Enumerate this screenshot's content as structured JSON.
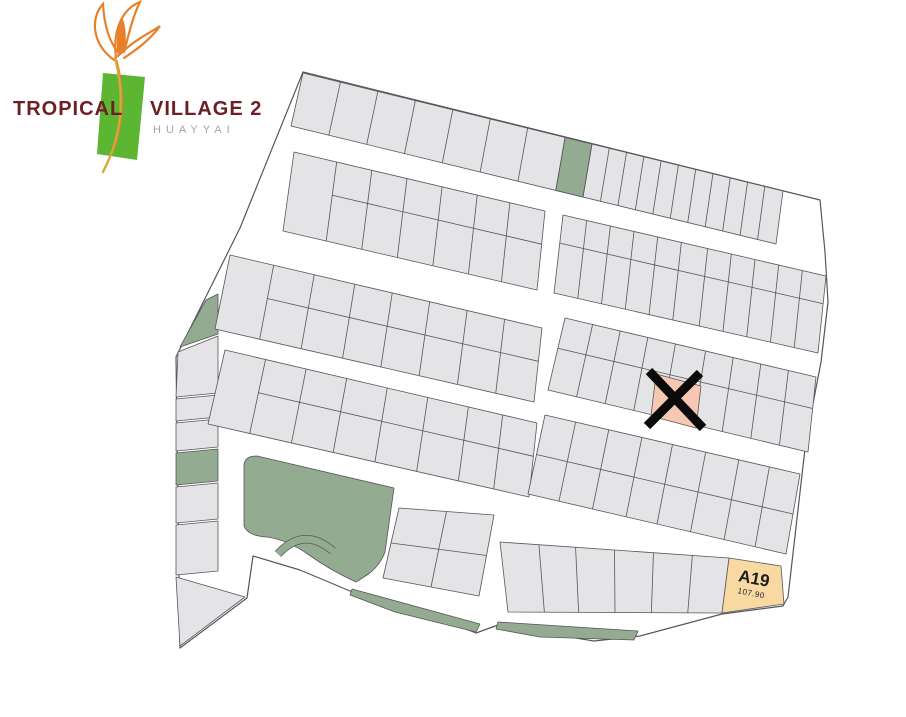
{
  "logo": {
    "title_left": "TROPICAL",
    "title_right": "VILLAGE 2",
    "subtitle": "HUAYYAI",
    "text_color": "#6e1e25",
    "subtitle_color": "#a5a3a3",
    "leaf_color": "#5cb632",
    "flower_color": "#e8802b",
    "stem_color": "#d9a83d"
  },
  "map": {
    "colors": {
      "background": "#ffffff",
      "plot": "#e4e4e6",
      "line": "#55565a",
      "green": "#93ab90",
      "salmon": "#f6c8b2",
      "yellow": "#f8d9a1",
      "mark": "#0b0b0b",
      "label_dark": "#1d1d1f"
    },
    "outline": [
      [
        303,
        72
      ],
      [
        820,
        200
      ],
      [
        825,
        252
      ],
      [
        828,
        302
      ],
      [
        821,
        362
      ],
      [
        806,
        440
      ],
      [
        788,
        597
      ],
      [
        783,
        606
      ],
      [
        722,
        614
      ],
      [
        640,
        636
      ],
      [
        594,
        641
      ],
      [
        540,
        632
      ],
      [
        498,
        625
      ],
      [
        476,
        633
      ],
      [
        430,
        615
      ],
      [
        398,
        610
      ],
      [
        350,
        591
      ],
      [
        300,
        570
      ],
      [
        253,
        556
      ],
      [
        247,
        598
      ],
      [
        180,
        648
      ],
      [
        176,
        357
      ],
      [
        240,
        228
      ]
    ],
    "blocks": [
      {
        "name": "row-1",
        "poly": [
          [
            303,
            73
          ],
          [
            783,
            191
          ],
          [
            776,
            244
          ],
          [
            291,
            126
          ]
        ],
        "cuts": [
          0.078,
          0.156,
          0.234,
          0.312,
          0.39,
          0.468,
          0.546,
          0.602,
          0.638,
          0.674,
          0.71,
          0.746,
          0.782,
          0.818,
          0.854,
          0.89,
          0.926,
          0.962
        ],
        "fills": [
          {
            "from": 0.546,
            "to": 0.602,
            "color": "green"
          }
        ]
      },
      {
        "name": "row-2-left",
        "poly": [
          [
            294,
            152
          ],
          [
            545,
            211
          ],
          [
            537,
            290
          ],
          [
            283,
            231
          ]
        ],
        "cuts": [
          0.17,
          0.31,
          0.45,
          0.59,
          0.73,
          0.86
        ],
        "mid": 0.42,
        "midStart": 0.17
      },
      {
        "name": "row-2-right",
        "poly": [
          [
            563,
            215
          ],
          [
            826,
            276
          ],
          [
            818,
            353
          ],
          [
            554,
            293
          ]
        ],
        "cuts": [
          0.09,
          0.18,
          0.27,
          0.36,
          0.45,
          0.55,
          0.64,
          0.73,
          0.82,
          0.91
        ],
        "mid": 0.36
      },
      {
        "name": "row-3-left",
        "poly": [
          [
            230,
            255
          ],
          [
            542,
            328
          ],
          [
            534,
            402
          ],
          [
            215,
            329
          ]
        ],
        "cuts": [
          0.14,
          0.27,
          0.4,
          0.52,
          0.64,
          0.76,
          0.88
        ],
        "mid": 0.45,
        "midStart": 0.14
      },
      {
        "name": "row-3-right",
        "poly": [
          [
            565,
            318
          ],
          [
            816,
            377
          ],
          [
            808,
            452
          ],
          [
            548,
            390
          ]
        ],
        "cuts": [
          0.11,
          0.22,
          0.33,
          0.44,
          0.56,
          0.67,
          0.78,
          0.89
        ],
        "mid": 0.42
      },
      {
        "name": "row-4-left",
        "poly": [
          [
            225,
            350
          ],
          [
            537,
            423
          ],
          [
            529,
            497
          ],
          [
            208,
            424
          ]
        ],
        "cuts": [
          0.13,
          0.26,
          0.39,
          0.52,
          0.65,
          0.78,
          0.89
        ],
        "mid": 0.45,
        "midStart": 0.13
      },
      {
        "name": "row-4-right",
        "poly": [
          [
            545,
            415
          ],
          [
            800,
            474
          ],
          [
            786,
            554
          ],
          [
            528,
            494
          ]
        ],
        "cuts": [
          0.12,
          0.25,
          0.38,
          0.5,
          0.63,
          0.76,
          0.88
        ],
        "mid": 0.5
      },
      {
        "name": "pond-side-block",
        "poly": [
          [
            399,
            508
          ],
          [
            494,
            515
          ],
          [
            479,
            596
          ],
          [
            383,
            578
          ]
        ],
        "cuts": [
          0.5
        ],
        "mid": 0.5
      },
      {
        "name": "bottom-row",
        "poly": [
          [
            500,
            542
          ],
          [
            729,
            558
          ],
          [
            722,
            613
          ],
          [
            508,
            612
          ]
        ],
        "cuts": [
          0.17,
          0.33,
          0.5,
          0.67,
          0.84
        ]
      }
    ],
    "strip_cells": [
      {
        "poly": [
          [
            206,
            300
          ],
          [
            218,
            294
          ],
          [
            218,
            334
          ],
          [
            180,
            347
          ]
        ],
        "color": "green"
      },
      {
        "poly": [
          [
            178,
            352
          ],
          [
            218,
            336
          ],
          [
            218,
            393
          ],
          [
            176,
            397
          ]
        ],
        "color": "plot"
      },
      {
        "poly": [
          [
            176,
            399
          ],
          [
            218,
            395
          ],
          [
            218,
            417
          ],
          [
            176,
            421
          ]
        ],
        "color": "plot"
      },
      {
        "poly": [
          [
            176,
            423
          ],
          [
            218,
            419
          ],
          [
            218,
            447
          ],
          [
            176,
            451
          ]
        ],
        "color": "plot"
      },
      {
        "poly": [
          [
            176,
            453
          ],
          [
            218,
            449
          ],
          [
            218,
            481
          ],
          [
            176,
            485
          ]
        ],
        "color": "green"
      },
      {
        "poly": [
          [
            176,
            487
          ],
          [
            218,
            483
          ],
          [
            218,
            519
          ],
          [
            176,
            523
          ]
        ],
        "color": "plot"
      },
      {
        "poly": [
          [
            176,
            525
          ],
          [
            218,
            521
          ],
          [
            218,
            571
          ],
          [
            176,
            575
          ]
        ],
        "color": "plot"
      },
      {
        "poly": [
          [
            176,
            577
          ],
          [
            245,
            597
          ],
          [
            180,
            646
          ]
        ],
        "color": "plot"
      }
    ],
    "park_path": "M257,456 L394,488 L385,552 Q380,566 367,575 L356,582 Q330,570 309,555 Q288,540 267,537 Q248,536 244,526 L244,466 Q244,456 257,456 Z",
    "arc_path": "M278,554 Q304,526 333,551",
    "green_bands": [
      [
        [
          352,
          589
        ],
        [
          480,
          624
        ],
        [
          476,
          632
        ],
        [
          395,
          612
        ],
        [
          350,
          595
        ]
      ],
      [
        [
          498,
          622
        ],
        [
          638,
          631
        ],
        [
          634,
          640
        ],
        [
          540,
          637
        ],
        [
          496,
          629
        ]
      ]
    ],
    "marked_plot": {
      "poly": [
        [
          656,
          374
        ],
        [
          701,
          386
        ],
        [
          696,
          428
        ],
        [
          651,
          416
        ]
      ],
      "cross_lines": [
        [
          [
            649,
            371
          ],
          [
            703,
            428
          ]
        ],
        [
          [
            700,
            373
          ],
          [
            647,
            426
          ]
        ]
      ]
    },
    "a19": {
      "label": "A19",
      "area": "107.90",
      "poly": [
        [
          729,
          558
        ],
        [
          781,
          566
        ],
        [
          784,
          604
        ],
        [
          722,
          613
        ]
      ]
    }
  }
}
